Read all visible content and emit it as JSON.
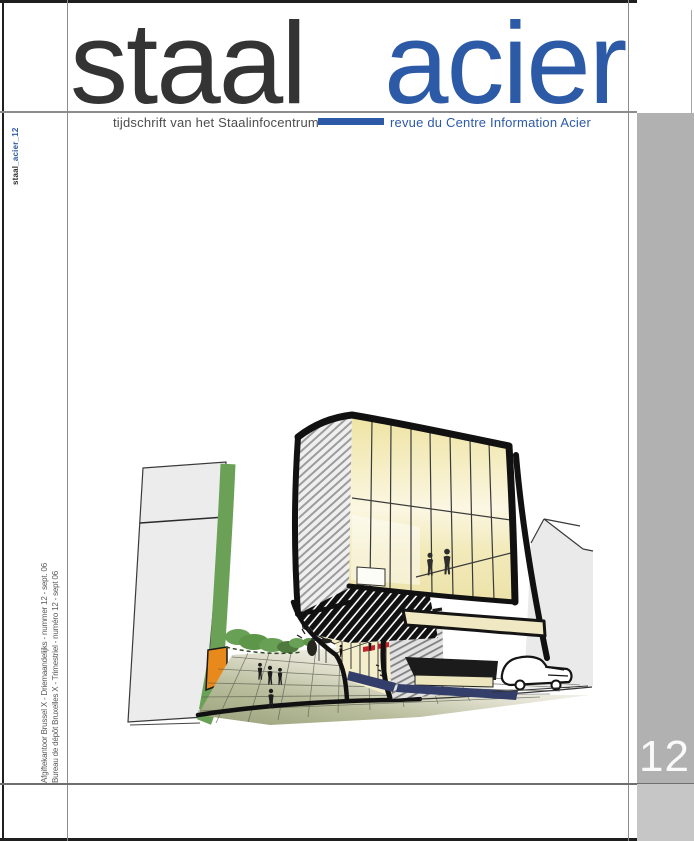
{
  "masthead": {
    "title_left": "staal",
    "title_right": "acier",
    "subtitle_left": "tijdschrift van het Staalinfocentrum",
    "subtitle_right": "revue du Centre Information Acier"
  },
  "spine": {
    "top_label_dark": "staal",
    "top_label_blue": "_acier_12",
    "imprint_line1": "Afgiftekantoor Brussel X - Driemaandelijks - nummer 12 - sept. 06",
    "imprint_line2": "Bureau de dépôt Bruxelles X - Trimestriel - numéro 12 - sept 06"
  },
  "issue": {
    "number": "12"
  },
  "colors": {
    "blue": "#2d5aa6",
    "panel": "#b1b1b1",
    "panel-light": "#c6c6c6",
    "ink": "#1f1f1f"
  },
  "illustration": {
    "alt": "hand-drawn architectural sketch: cantilevered glass cube building above a plaza with trees, pedestrians and a car",
    "palette": {
      "glass_yellow": "#f3ecc0",
      "green": "#6aa157",
      "orange": "#e8891c",
      "navy": "#333e6b",
      "sign_red": "#c4222a",
      "sketch_gray": "#eaeaea"
    }
  }
}
